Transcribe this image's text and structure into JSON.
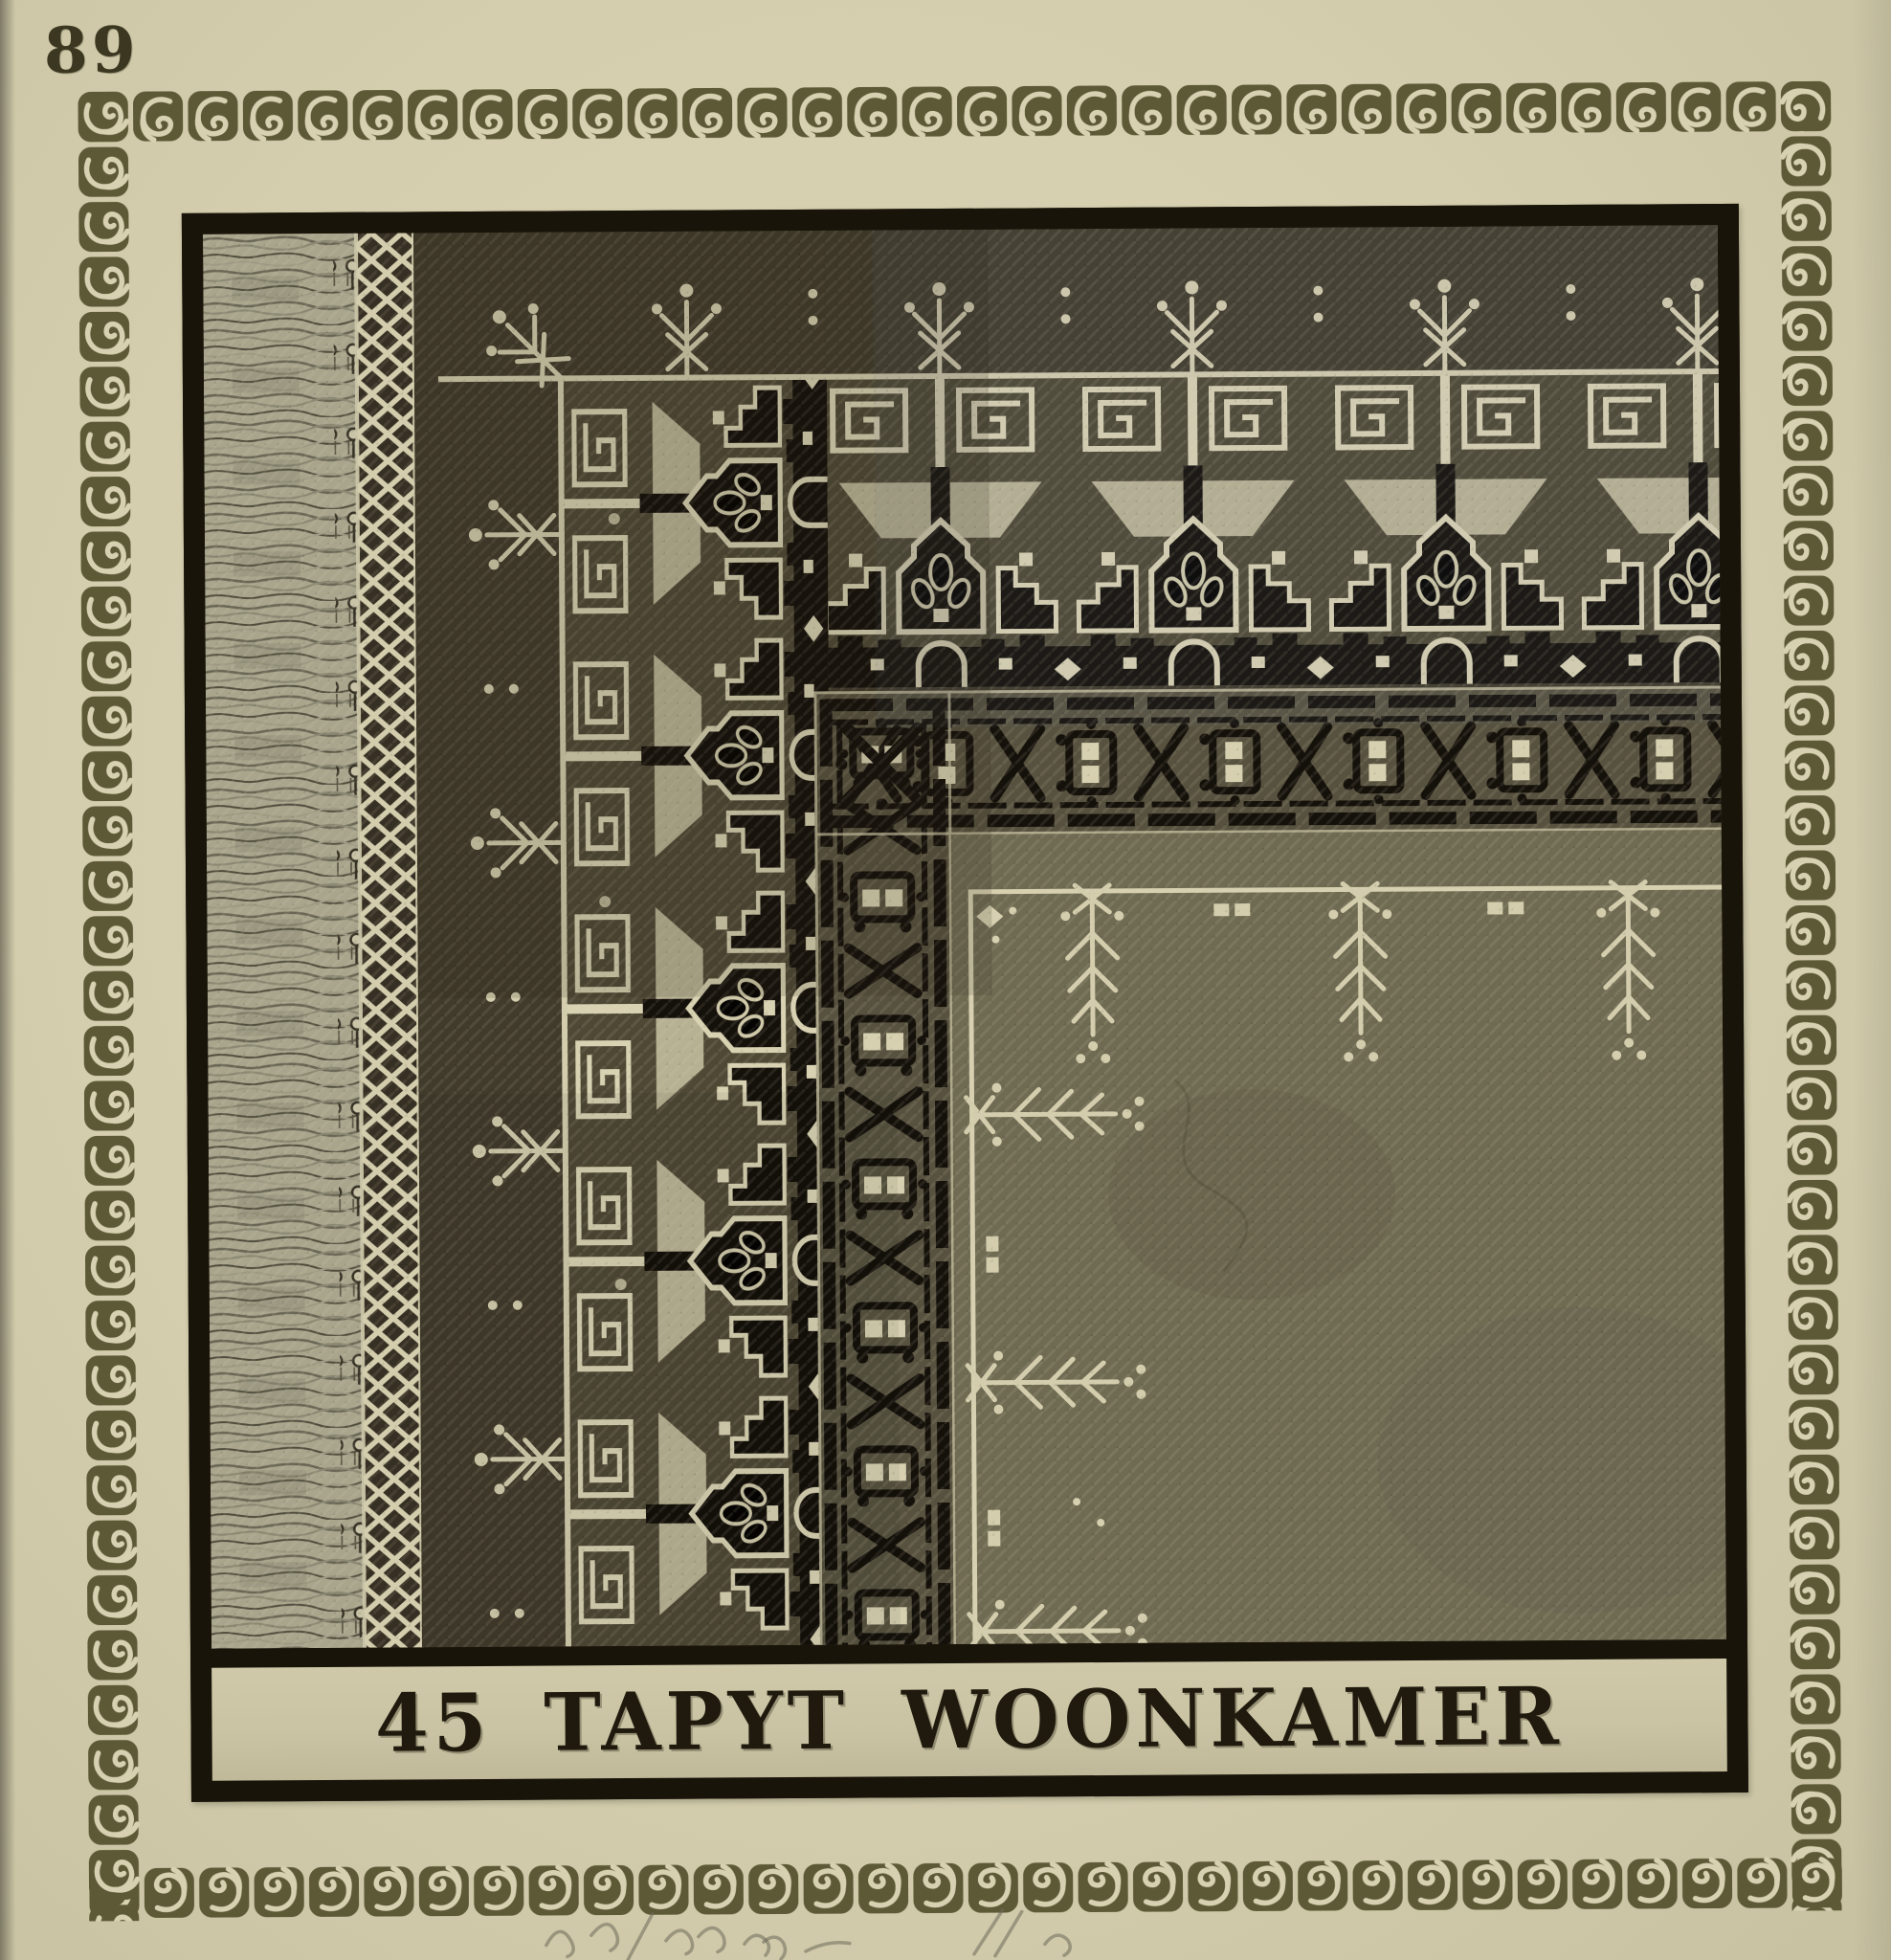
{
  "page": {
    "number": "89"
  },
  "plate": {
    "caption": "45 TAPYT WOONKAMER"
  },
  "palette": {
    "page_bg": "#d5cfae",
    "frame_olive": "#5d5836",
    "plate_black": "#191409",
    "carpet_dark_ground": "#413b2c",
    "carpet_field": "#6f6b53",
    "motif_cream": "#d6d0b0",
    "motif_black": "#14100a",
    "caption_bg": "#cbc5a5",
    "ink": "#201a0e"
  },
  "carpet_regions": [
    "fringe",
    "lattice-band",
    "outer-dark-zone",
    "main-ornamental-border",
    "guard-chain-band",
    "open-field"
  ]
}
